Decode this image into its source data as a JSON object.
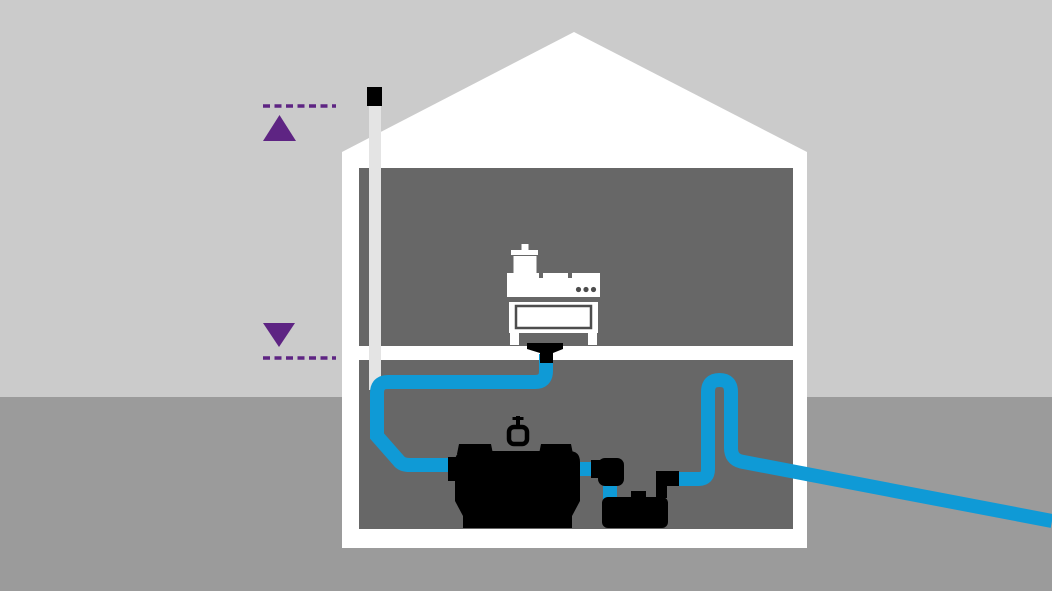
{
  "diagram": {
    "type": "cutaway-house-wastewater-lifting-station",
    "parts": [
      "sky",
      "ground",
      "house-shell",
      "upper-floor-room",
      "basement-room",
      "vent-stack-pipe",
      "vent-stack-cap",
      "high-level-marker",
      "low-level-marker",
      "kitchen-stove",
      "cooking-pot",
      "floor-drain-funnel",
      "drain-pipe",
      "collection-tank",
      "tank-vent-valve",
      "macerator-pump",
      "discharge-pipe-loop",
      "discharge-pipe-outfall"
    ]
  },
  "colors": {
    "sky": "#cbcbcb",
    "ground": "#9b9b9b",
    "house": "#ffffff",
    "room": "#676767",
    "pipe_blue": "#0f9ad6",
    "marker_purple": "#5e2483",
    "equipment_black": "#000000",
    "vent_gray": "#e4e4e4",
    "detail_gray": "#4d4d4d",
    "white": "#ffffff"
  }
}
